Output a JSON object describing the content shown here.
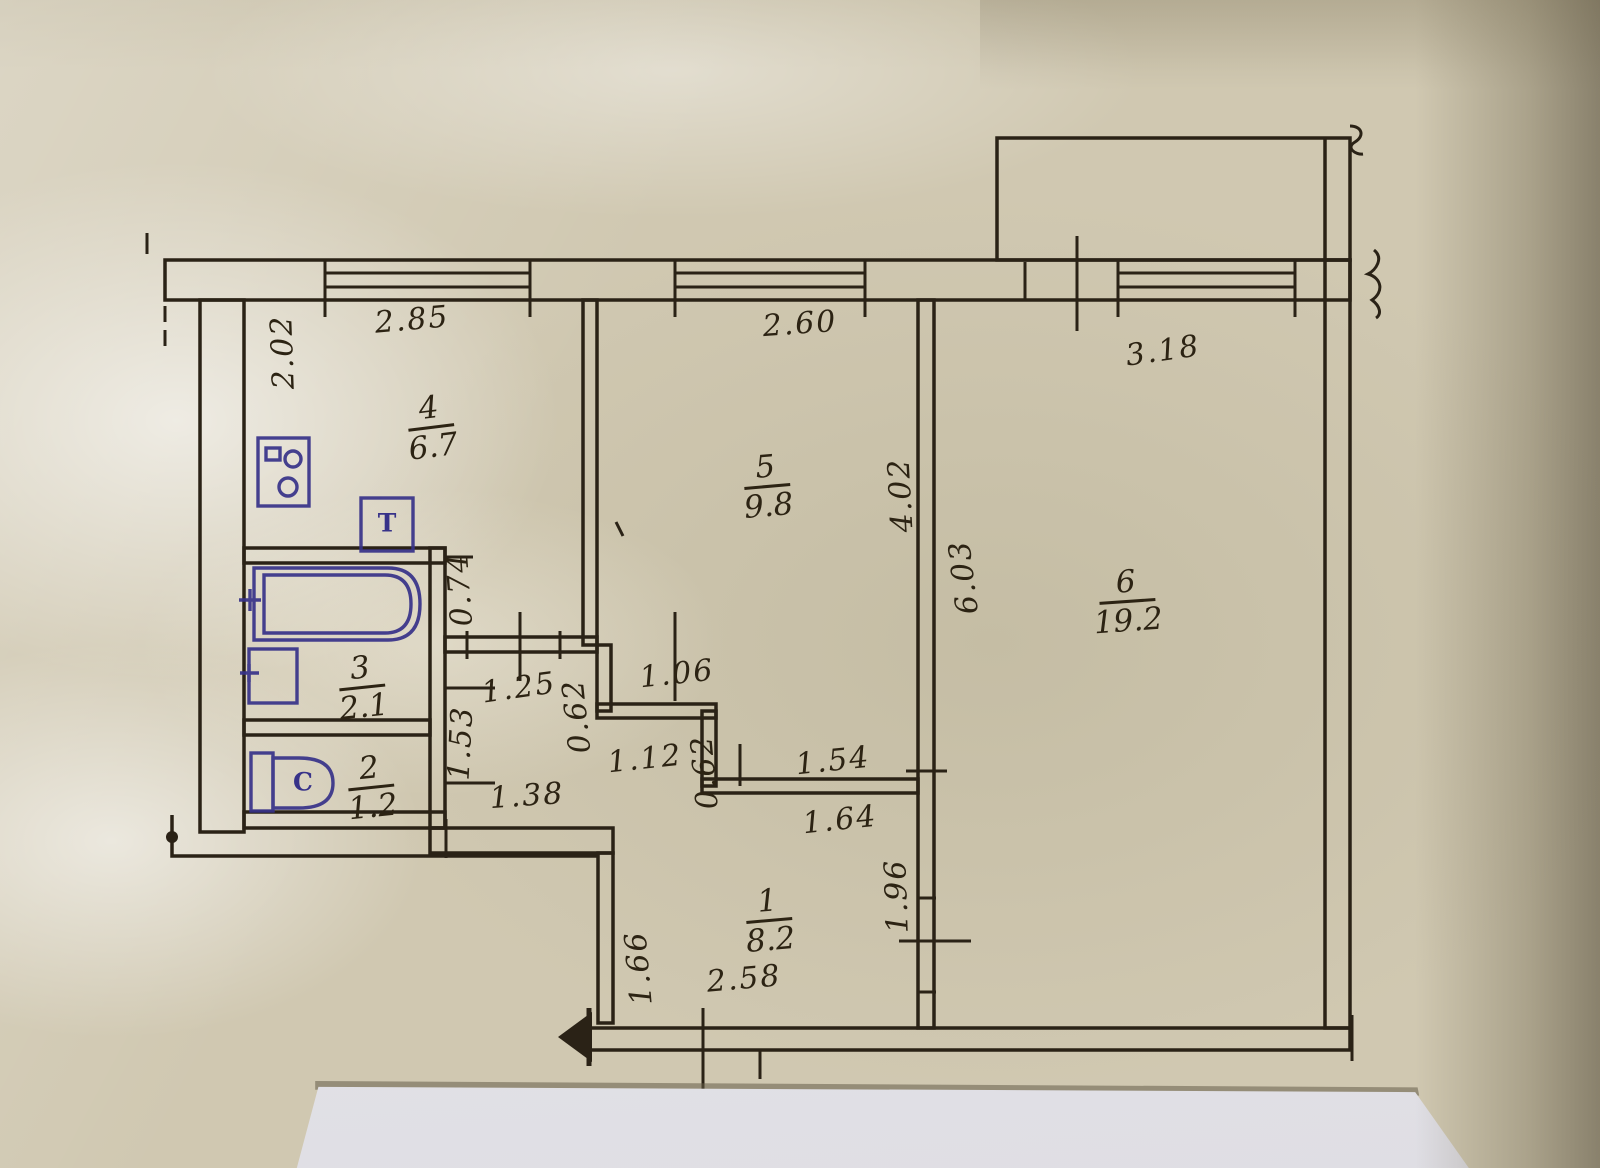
{
  "document": {
    "kind": "apartment floor plan (hand-drawn BTI sheet photo)"
  },
  "rooms": {
    "hall": {
      "number": "1",
      "area": "8.2"
    },
    "wc": {
      "number": "2",
      "area": "1.2"
    },
    "bath": {
      "number": "3",
      "area": "2.1"
    },
    "kitchen": {
      "number": "4",
      "area": "6.7"
    },
    "bedroom": {
      "number": "5",
      "area": "9.8"
    },
    "living": {
      "number": "6",
      "area": "19.2"
    }
  },
  "dims": {
    "w_kitchen": "2.85",
    "w_bedroom": "2.60",
    "w_living": "3.18",
    "h_kitchen_left": "2.02",
    "seg_074": "0.74",
    "seg_125": "1.25",
    "seg_062a": "0.62",
    "seg_106": "1.06",
    "seg_153": "1.53",
    "seg_112": "1.12",
    "seg_062b": "0.62",
    "seg_154": "1.54",
    "seg_164": "1.64",
    "seg_138": "1.38",
    "seg_196": "1.96",
    "seg_166": "1.66",
    "seg_258": "2.58",
    "seg_402": "4.02",
    "seg_603": "6.03"
  },
  "fixtures": {
    "toilet_letter": "C",
    "heater_letter": "T"
  },
  "colors": {
    "paper": "#d0c8b1",
    "ink": "#2a2216",
    "fixture_ink": "#373289",
    "white_paper": "#eceaef"
  }
}
